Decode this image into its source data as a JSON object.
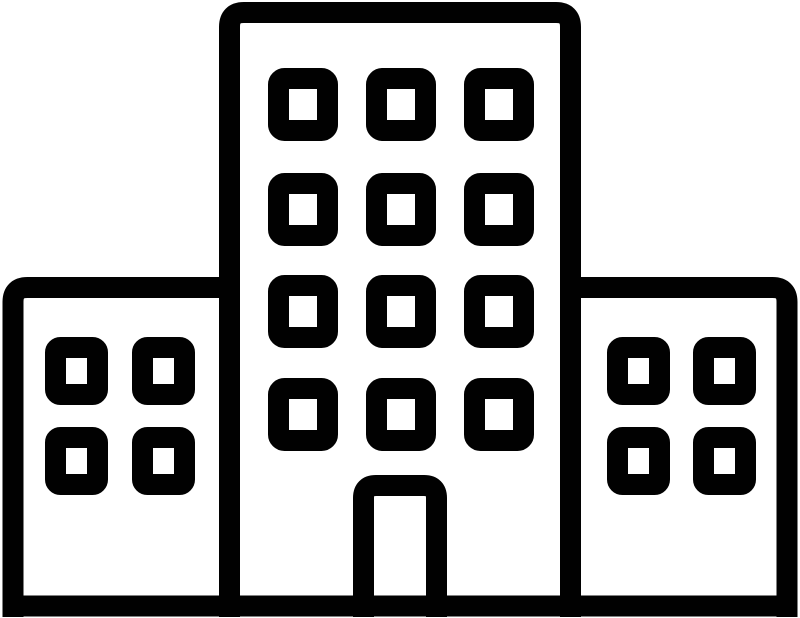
{
  "icon": {
    "name": "office-building-icon",
    "description": "Black outline pictogram of a building complex: a tall central tower with twelve windows and an open door, flanked by two shorter wings with four windows each, standing on a ground line",
    "stroke_color": "#010101",
    "background_color": "#ffffff",
    "central_building": {
      "window_rows": 4,
      "window_columns": 3,
      "window_count": 12,
      "has_door": true
    },
    "left_wing": {
      "window_rows": 2,
      "window_columns": 2,
      "window_count": 4
    },
    "right_wing": {
      "window_rows": 2,
      "window_columns": 2,
      "window_count": 4
    }
  }
}
